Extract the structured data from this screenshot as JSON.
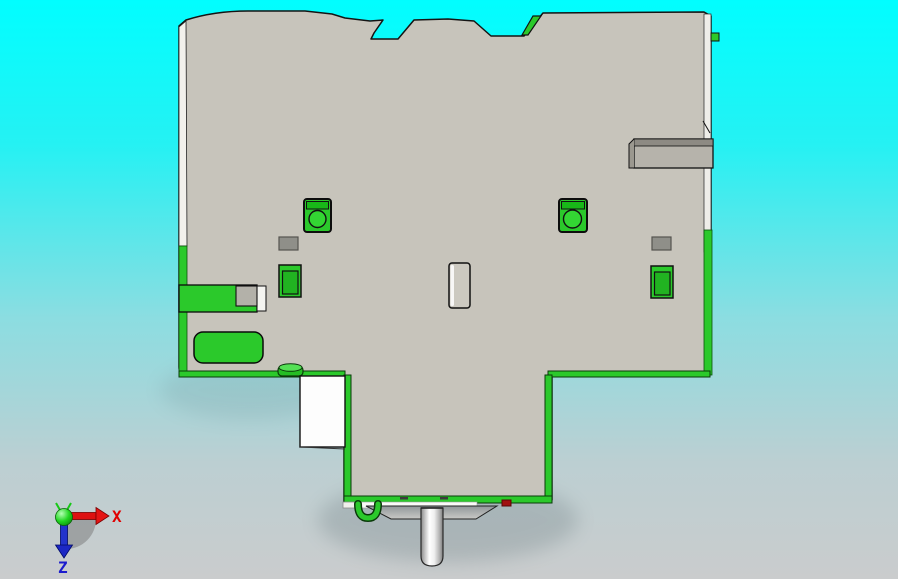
{
  "viewport": {
    "name": "cad-part-top-view",
    "background_top": "#01feff",
    "background_bottom": "#cacccd"
  },
  "part": {
    "body_color": "#c7c4bb",
    "outline_color": "#141414",
    "accent_green": "#2bc92b",
    "accent_green_dark": "#18a818",
    "inner_green": "#21b321",
    "circle_green": "#33d633",
    "clip_color": "#b6b3ab",
    "clip_band_color": "#8d8a83",
    "pad_gray": "#8f8f89",
    "marker_red": "#a01010",
    "white_detail": "#fdfdfd"
  },
  "triad": {
    "x_label": "X",
    "z_label": "Z",
    "x_color": "#e00000",
    "z_color": "#1c1ccd",
    "origin_color": "#16c916",
    "shadow_color": "#787878"
  }
}
